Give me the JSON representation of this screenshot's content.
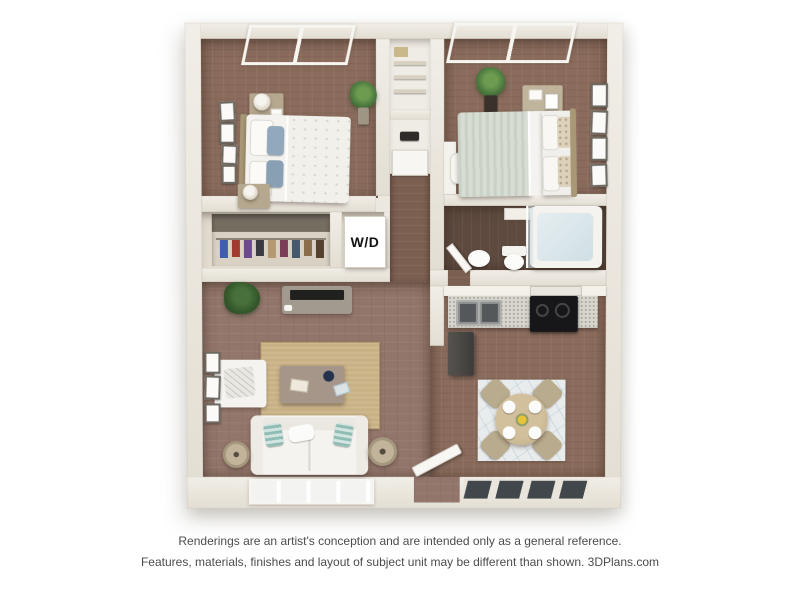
{
  "image": {
    "type": "3d-floor-plan-rendering",
    "background": "#ffffff"
  },
  "floor_plan": {
    "labels": {
      "washer_dryer": "W/D"
    },
    "palette": {
      "wall": "#ece9e1",
      "bedroom_floor": "#8a6b5c",
      "living_floor": "#93766b",
      "bathroom_floor": "#5e4a3f",
      "hallway_floor": "#7b5f51",
      "living_rug": "#c8b184",
      "dining_rug": "#e9ecec",
      "kitchen_counter": "#d7d5cc",
      "stove": "#171719",
      "pillow_blue": "#92a8bc",
      "pillow_teal": "#8fbcb4",
      "duvet_sage": "#ccd3c8",
      "plant_green": "#4c7a3f",
      "wood_furniture": "#b6a88f"
    }
  },
  "disclaimer": {
    "line1": "Renderings are an artist's conception and are intended only as a general reference.",
    "line2": "Features, materials, finishes and layout of subject unit may be different than shown. 3DPlans.com"
  }
}
